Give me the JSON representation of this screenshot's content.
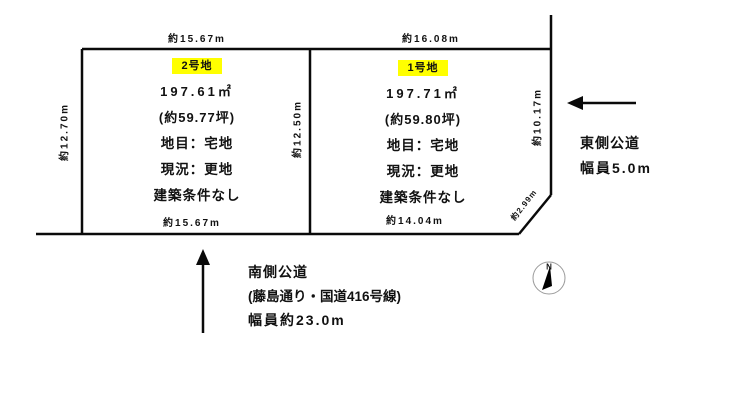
{
  "diagram": {
    "plots": [
      {
        "badge": "2号地",
        "area": "197.61㎡",
        "tsubo": "(約59.77坪)",
        "land_category": "地目：宅地",
        "current_state": "現況：更地",
        "building_condition": "建築条件なし",
        "dim_top": "約15.67m",
        "dim_bottom": "約15.67m",
        "dim_left": "約12.70m",
        "dim_right": "約12.50m"
      },
      {
        "badge": "1号地",
        "area": "197.71㎡",
        "tsubo": "(約59.80坪)",
        "land_category": "地目：宅地",
        "current_state": "現況：更地",
        "building_condition": "建築条件なし",
        "dim_top": "約16.08m",
        "dim_bottom": "約14.04m",
        "dim_right": "約10.17m",
        "dim_corner": "約2.99m"
      }
    ],
    "roads": {
      "east": {
        "name": "東側公道",
        "width": "幅員5.0m"
      },
      "south": {
        "name": "南側公道",
        "route": "(藤島通り・国道416号線)",
        "width": "幅員約23.0m"
      }
    },
    "compass": {
      "north": "N"
    },
    "colors": {
      "badge_highlight": "#ffff00",
      "line": "#000000"
    }
  }
}
